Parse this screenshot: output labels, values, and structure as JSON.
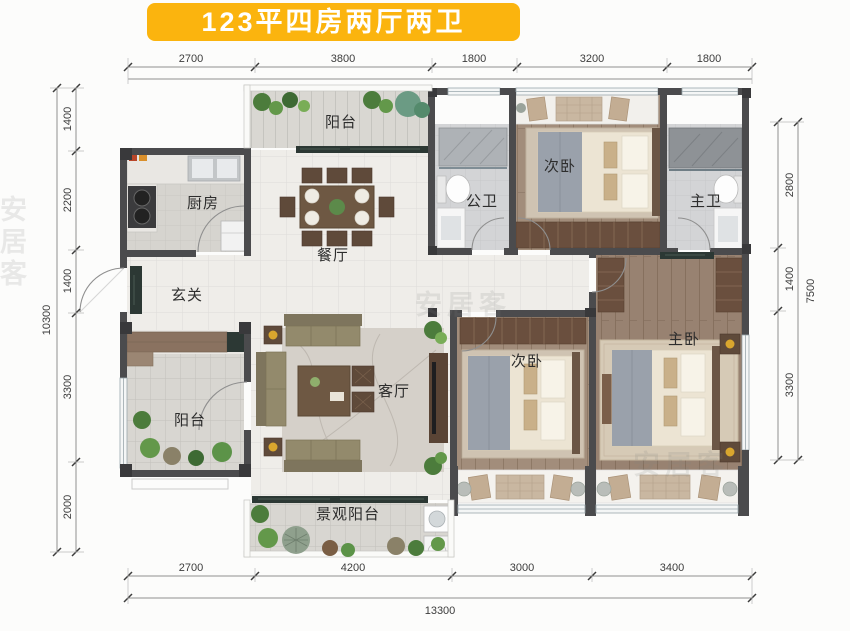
{
  "title": "123平四房两厅两卫",
  "watermark": "安居客",
  "rooms": {
    "balcony_top": "阳台",
    "kitchen": "厨房",
    "dining_room": "餐厅",
    "entry_hall": "玄关",
    "public_bathroom": "公卫",
    "second_bedroom_top": "次卧",
    "master_bathroom": "主卫",
    "balcony_left": "阳台",
    "living_room": "客厅",
    "second_bedroom_bottom": "次卧",
    "master_bedroom": "主卧",
    "view_balcony": "景观阳台"
  },
  "dimensions": {
    "top": [
      "2700",
      "3800",
      "1800",
      "3200",
      "1800"
    ],
    "bottom": [
      "2700",
      "4200",
      "3000",
      "3400"
    ],
    "bottom_total": "13300",
    "left": [
      "1400",
      "2200",
      "1400",
      "3300",
      "2000"
    ],
    "left_total": "10300",
    "right": [
      "2800",
      "1400",
      "3300"
    ],
    "right_total": "7500"
  },
  "colors": {
    "title_bg": "#FBB40E",
    "title_text": "#FFFFFF",
    "wall": "#4B4B4D",
    "wood_floor": "#A28D7B",
    "tile_floor": "#EFEDE9",
    "bath_floor": "#D3D4D6",
    "balcony_floor": "#D8D6D1",
    "threshold_marble": "#2C3834",
    "accent_gold": "#D9A62E",
    "plant_green": "#5C9348",
    "dimension_text": "#3C3C3C"
  }
}
